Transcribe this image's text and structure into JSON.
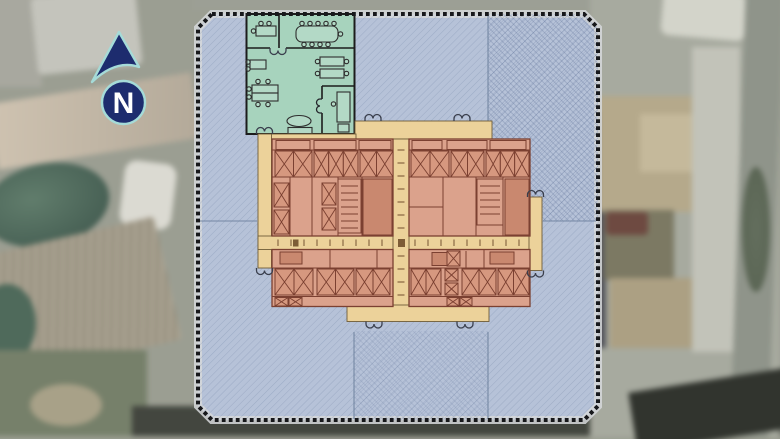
{
  "scene": {
    "kind": "building floor plan overlaid on aerial photograph"
  },
  "compass": {
    "label": "N"
  },
  "colors": {
    "floor_plate": "#b6c2d8",
    "office_suite": "#a7d3bd",
    "corridor": "#ecd29a",
    "core_rooms": "#dba28c",
    "core_rooms_dark": "#c9886f",
    "core_cell": "#d6987f",
    "core_wall": "#7b4031",
    "compass_navy": "#1d2c6e",
    "compass_cyan": "#a5dbd8"
  }
}
